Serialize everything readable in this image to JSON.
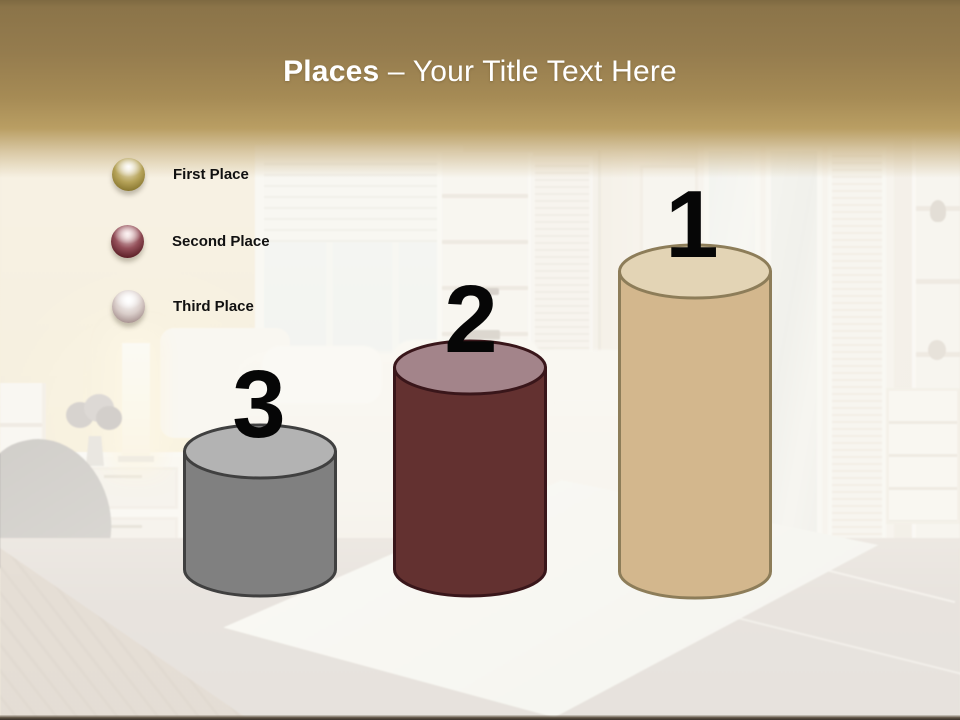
{
  "slide": {
    "title": {
      "bold": "Places",
      "separator": " – ",
      "rest": "Your Title Text Here",
      "text_color": "#ffffff"
    },
    "header": {
      "gold_dark": "#8b7449",
      "gold_light": "#c3a96e"
    },
    "bottom_bar_color": "#38302a"
  },
  "legend": {
    "items": [
      {
        "label": "First Place",
        "sphere_color": "#a1903f"
      },
      {
        "label": "Second Place",
        "sphere_color": "#6b2730"
      },
      {
        "label": "Third Place",
        "sphere_color": "#b5a09d"
      }
    ]
  },
  "podium": {
    "type": "cylinder-podium",
    "items": [
      {
        "rank": "1",
        "label": "First Place",
        "body_color": "#d3b78d",
        "top_color": "#e3d4b5",
        "outline_color": "#8d7d59",
        "height_px": 357
      },
      {
        "rank": "2",
        "label": "Second Place",
        "body_color": "#633130",
        "top_color": "#a3848a",
        "outline_color": "#39161a",
        "height_px": 259
      },
      {
        "rank": "3",
        "label": "Third Place",
        "body_color": "#808080",
        "top_color": "#b3b3b3",
        "outline_color": "#404040",
        "height_px": 175
      }
    ]
  }
}
